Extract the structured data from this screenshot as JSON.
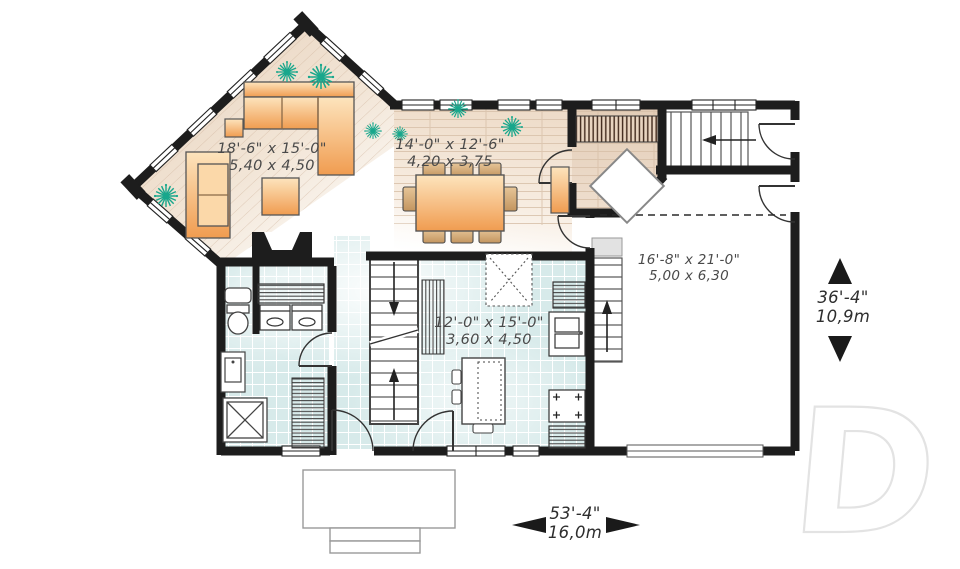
{
  "watermark": {
    "letter": "D"
  },
  "rooms": {
    "living": {
      "imperial": "18'-6\" x 15'-0\"",
      "metric": "5,40 x 4,50"
    },
    "dining": {
      "imperial": "14'-0\" x 12'-6\"",
      "metric": "4,20 x 3,75"
    },
    "kitchen": {
      "imperial": "12'-0\" x 15'-0\"",
      "metric": "3,60 x 4,50"
    },
    "garage": {
      "imperial": "16'-8\" x 21'-0\"",
      "metric": "5,00 x 6,30"
    }
  },
  "dimensions": {
    "overall_width": {
      "imperial": "53'-4\"",
      "metric": "16,0m"
    },
    "overall_depth": {
      "imperial": "36'-4\"",
      "metric": "10,9m"
    }
  },
  "colors": {
    "wall": "#1d1d1d",
    "wood_floor": "#ecd8c4",
    "tile_floor": "#d7eaea",
    "furniture_orange": "#f3a75f",
    "plant_teal": "#18a78c",
    "label_text": "#4a4a4a"
  }
}
